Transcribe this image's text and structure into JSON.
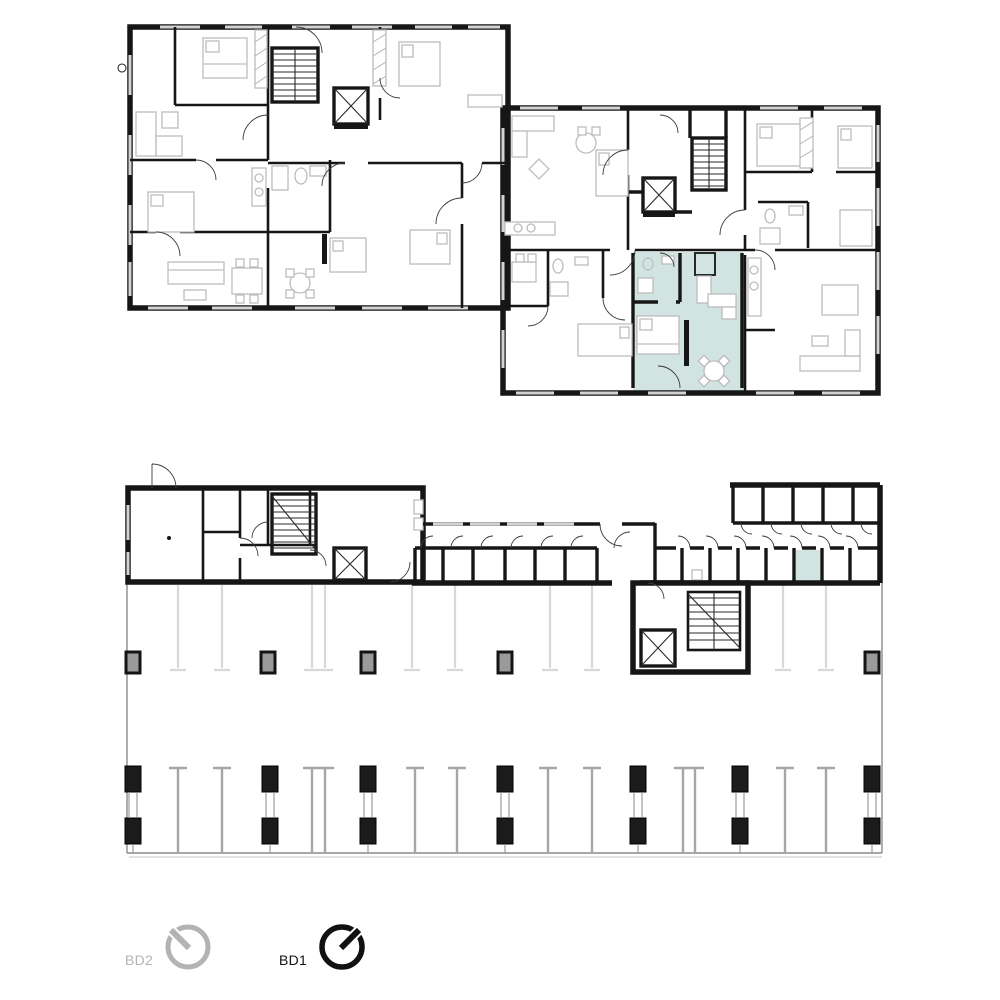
{
  "footer": {
    "buildings": [
      {
        "label": "BD2",
        "active": false,
        "icon": "compass-needle-northwest"
      },
      {
        "label": "BD1",
        "active": true,
        "icon": "compass-needle-northeast"
      }
    ]
  },
  "plans": {
    "highlight_color": "#d2e4e2"
  },
  "colors": {
    "highlight": "#d2e4e2",
    "wall": "#161616",
    "active": "#111111",
    "inactive": "#b3b3b3",
    "furniture": "#bdbdbd"
  }
}
